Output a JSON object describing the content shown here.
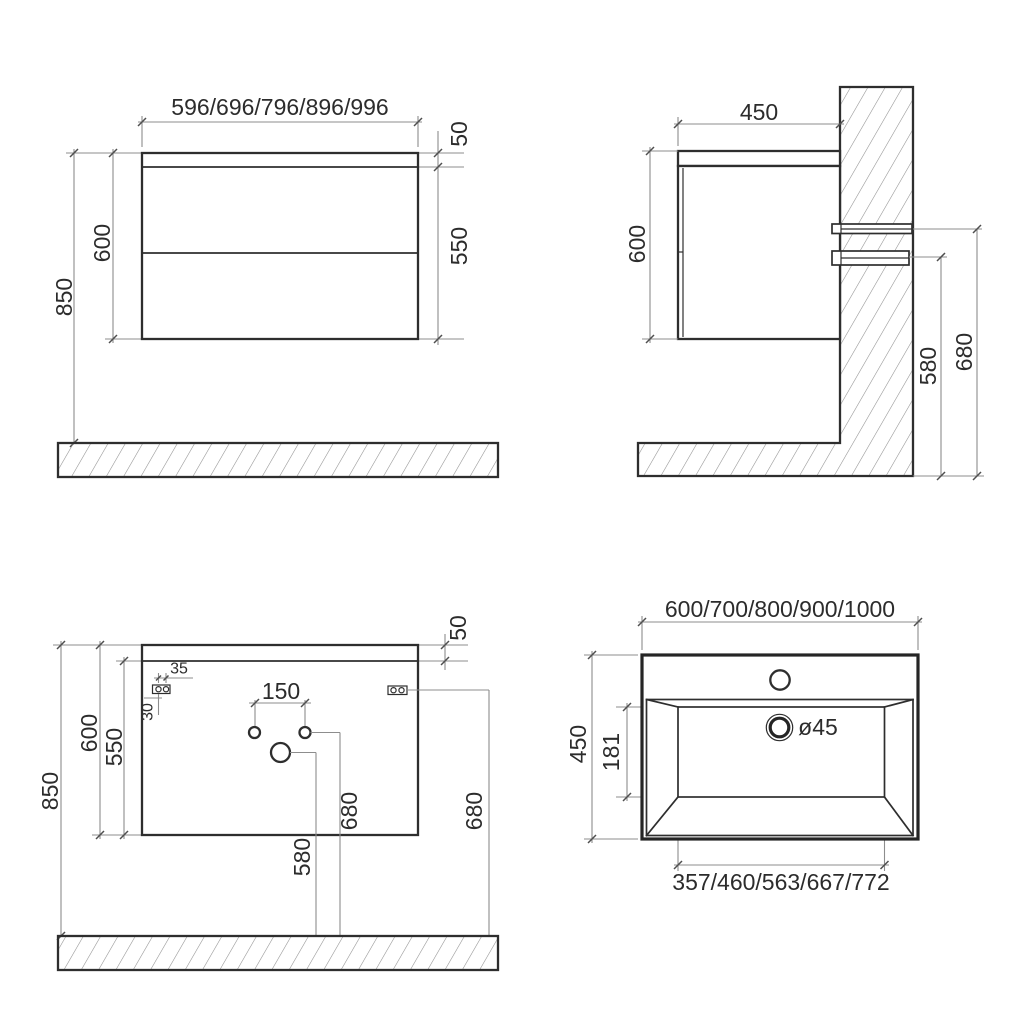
{
  "drawing": {
    "front": {
      "width": "596/696/796/896/996",
      "top_panel": "50",
      "door_height": "550",
      "cabinet_height": "600",
      "install_height": "850"
    },
    "side": {
      "depth": "450",
      "cabinet_height": "600",
      "lower_bracket_height": "580",
      "upper_bracket_height": "680"
    },
    "back": {
      "top_panel": "50",
      "bracket_hole_spacing": "35",
      "bracket_offset": "30",
      "faucet_hole_spacing": "150",
      "cabinet_height": "600",
      "door_height": "550",
      "install_height": "850",
      "supply_height": "680",
      "drain_height": "580",
      "bracket_height": "680"
    },
    "sink": {
      "width": "600/700/800/900/1000",
      "depth": "450",
      "basin_depth": "181",
      "drain_diameter": "ø45",
      "basin_width": "357/460/563/667/772"
    },
    "line_color": "#2e2e2e",
    "dim_color": "#8d8d8d"
  }
}
